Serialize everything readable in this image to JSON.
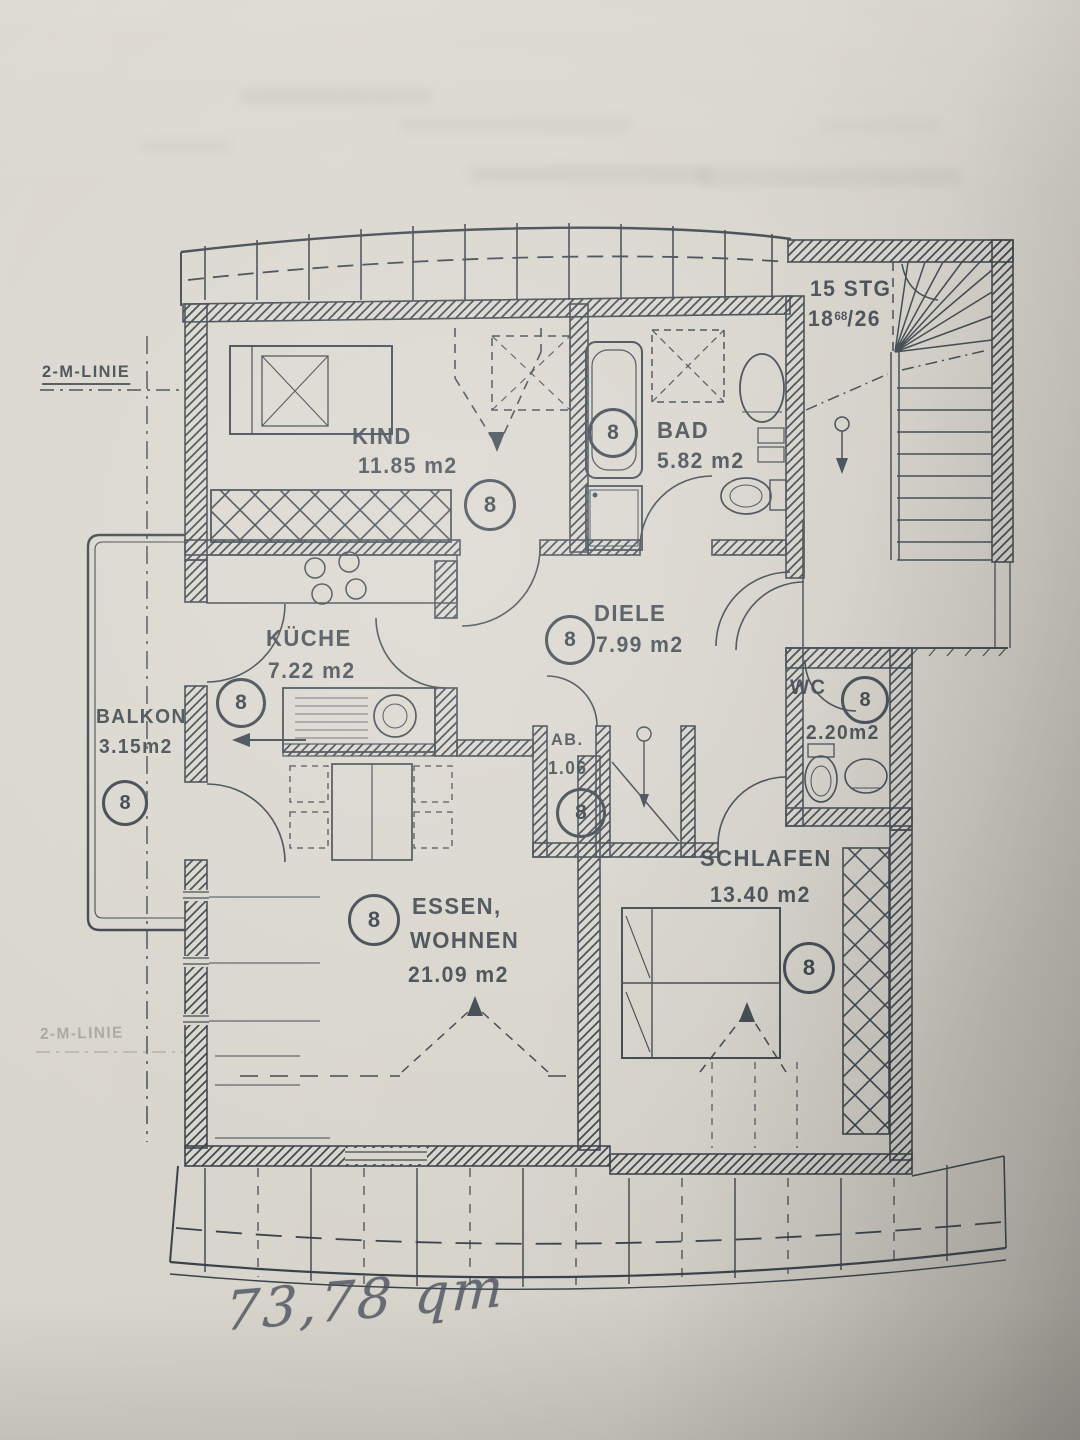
{
  "document": {
    "handwritten_total_area": "73,78 qm",
    "reference_line_label": "2-M-LINIE",
    "reference_line_label_lower": "2-M-LINIE"
  },
  "unit_marker": "8",
  "stairwell": {
    "label_steps": "15 STG",
    "label_riser": "18",
    "label_riser_sup": "68",
    "label_riser_rest": "/26"
  },
  "rooms": {
    "kind": {
      "name": "KIND",
      "area": "11.85 m2"
    },
    "bad": {
      "name": "BAD",
      "area": "5.82 m2"
    },
    "diele": {
      "name": "DIELE",
      "area": "7.99 m2"
    },
    "kueche": {
      "name": "KÜCHE",
      "area": "7.22 m2"
    },
    "balkon": {
      "name": "BALKON",
      "area": "3.15m2"
    },
    "ab": {
      "name": "AB.",
      "area": "1.06"
    },
    "wc": {
      "name": "WC",
      "area": "2.20m2"
    },
    "schlafen": {
      "name": "SCHLAFEN",
      "area": "13.40 m2"
    },
    "essen_wohnen": {
      "name_line1": "ESSEN,",
      "name_line2": "WOHNEN",
      "area": "21.09 m2"
    }
  },
  "colors": {
    "ink": "#3a434c",
    "paper": "#d7d4cb",
    "pencil": "#4e5462"
  }
}
